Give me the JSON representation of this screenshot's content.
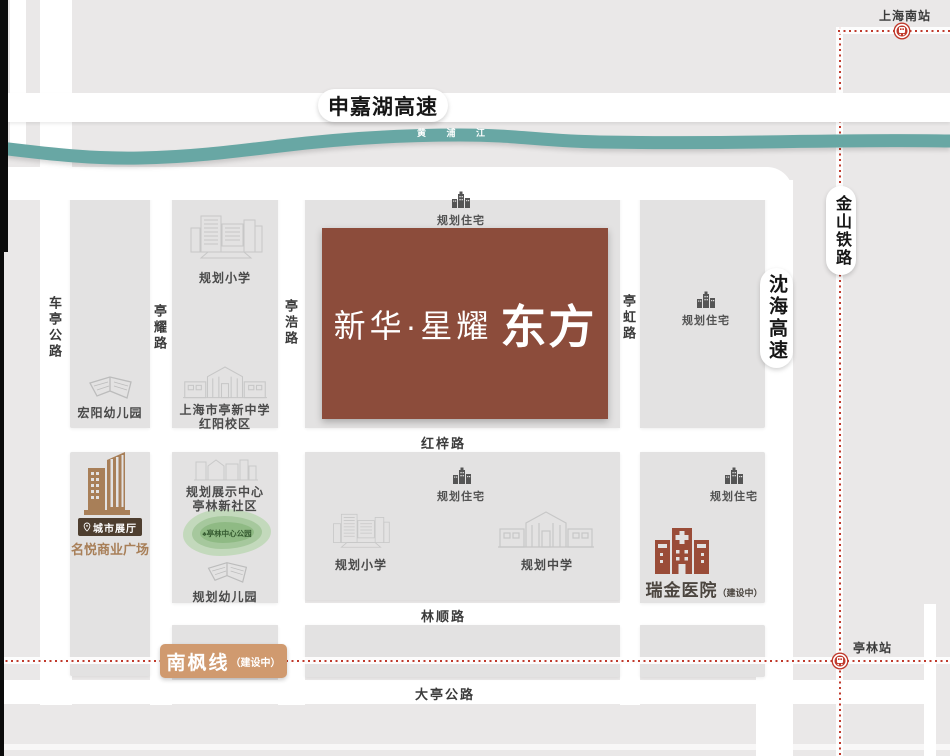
{
  "site": {
    "name_light": "新华·星耀",
    "name_bold": "东方"
  },
  "roads": {
    "shenjiahu_expressway": "申嘉湖高速",
    "shenhai_expressway": "沈海高速",
    "jinshan_railway": "金山铁路",
    "cheting_highway": "车亭公路",
    "tingyao_road": "亭耀路",
    "tinghao_road": "亭浩路",
    "tinghong_road": "亭虹路",
    "hongzi_road": "红梓路",
    "linshun_road": "林顺路",
    "dating_highway": "大亭公路"
  },
  "transit": {
    "nanfeng_line": "南枫线",
    "nanfeng_status": "（建设中）",
    "shanghai_south_station": "上海南站",
    "tinglin_station": "亭林站"
  },
  "river": {
    "name": "黄 浦 江"
  },
  "pois": {
    "planned_residence": "规划住宅",
    "planned_primary_school": "规划小学",
    "planned_middle_school": "规划中学",
    "planned_kindergarten": "规划幼儿园",
    "hongyang_kindergarten": "宏阳幼儿园",
    "tingxin_middle_school_line1": "上海市亭新中学",
    "tingxin_middle_school_line2": "红阳校区",
    "exhibition_center_line1": "规划展示中心",
    "exhibition_center_line2": "亭林新社区",
    "tinglin_central_park": "亭林中心公园",
    "city_exhibition_hall": "城市展厅",
    "mingyue_plaza": "名悦商业广场",
    "ruijin_hospital": "瑞金医院",
    "ruijin_hospital_status": "（建设中）"
  },
  "colors": {
    "site_brown": "#8c4c3b",
    "river_teal": "#68a7a4",
    "rail_red": "#c0392b",
    "nanfeng_tan": "#d09a6f",
    "hall_dark_brown": "#4e3e2f",
    "commerce_brown": "#a87f58",
    "hospital_red": "#9a4c38"
  }
}
